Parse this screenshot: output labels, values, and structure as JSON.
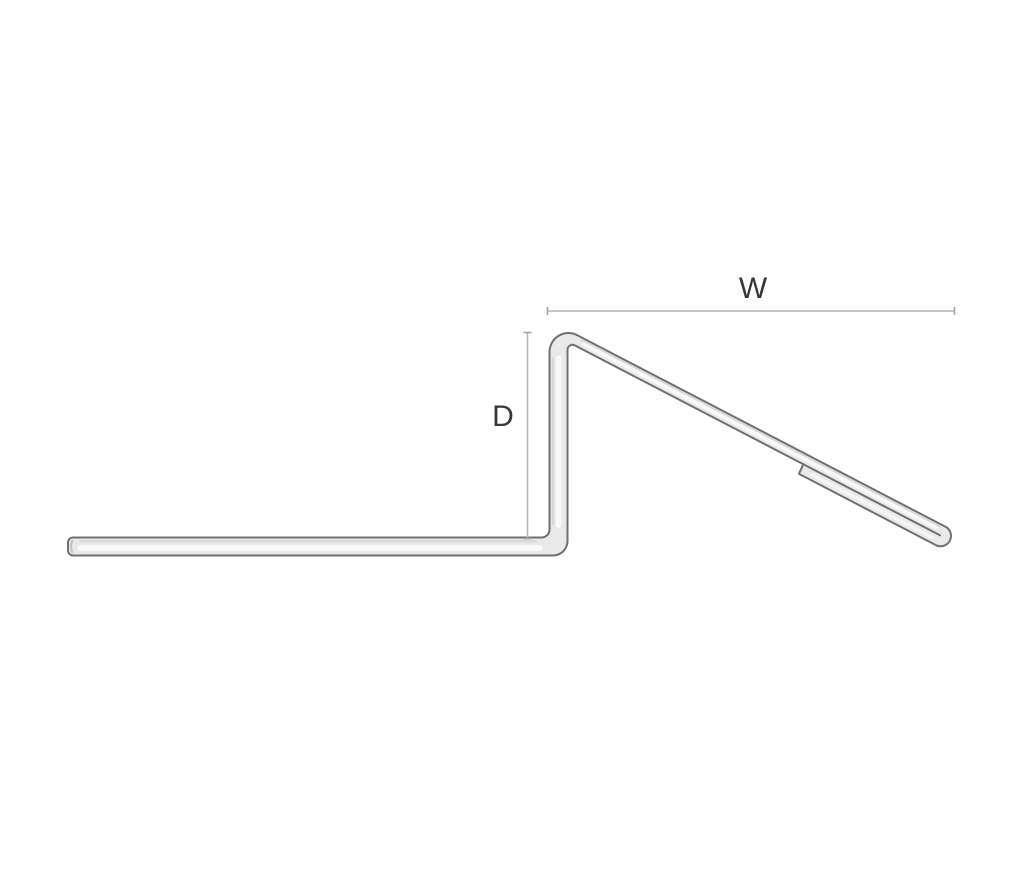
{
  "figure": {
    "title": "bent-metal-profile-cross-section",
    "description": "Line drawing of a bent sheet-metal profile: flat horizontal leg, vertical riser, and a downward-sloping top leg ending in a folded hem with rounded edge",
    "labels": {
      "width": "W",
      "depth": "D"
    },
    "colors": {
      "background": "#ffffff",
      "outline": "#707070",
      "fill": "#e9e9e9",
      "highlight": "#fafafa",
      "inner_shade": "#d7d7d7",
      "end_shade": "#c2c2c2",
      "dimension_line": "#b6b6b6",
      "tick": "#a3a3a3",
      "label_text": "#383838"
    }
  }
}
